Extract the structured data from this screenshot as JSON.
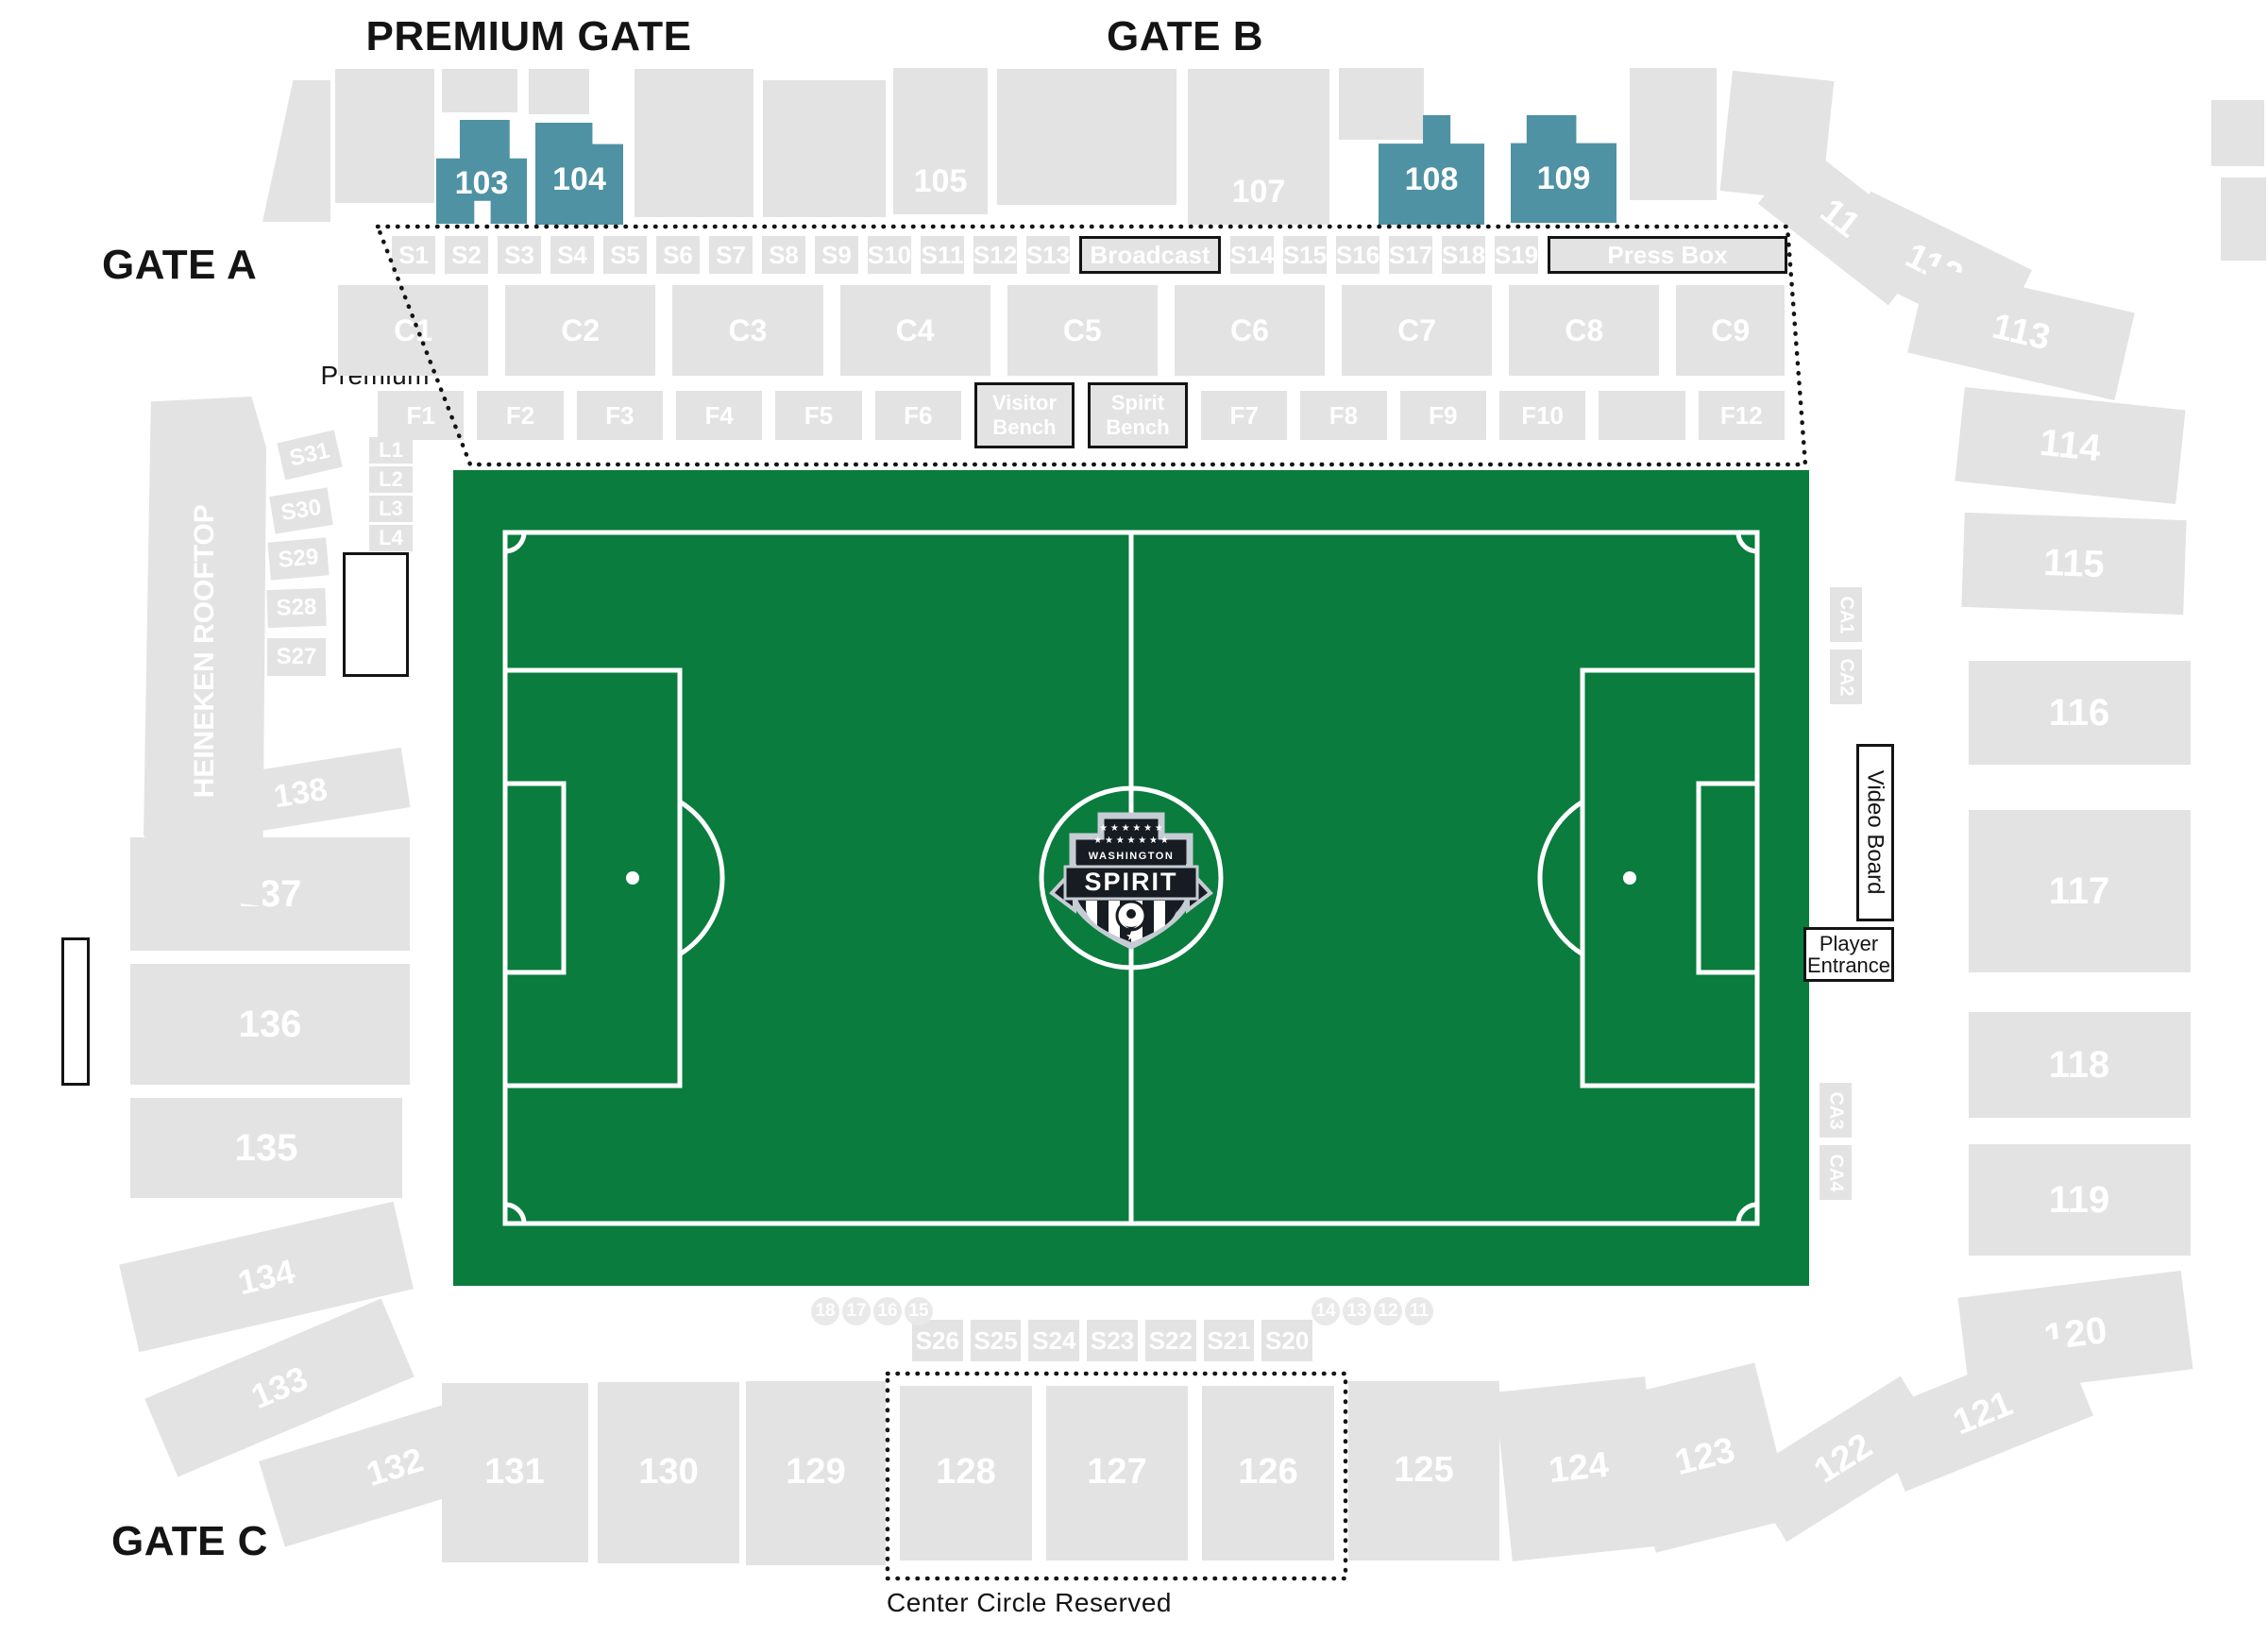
{
  "titles": {
    "premium_gate": "PREMIUM GATE",
    "gate_b": "GATE B",
    "gate_a": "GATE A",
    "gate_c": "GATE C",
    "premium": "Premium",
    "center_circle": "Center Circle Reserved"
  },
  "colors": {
    "section_gray": "#e3e3e3",
    "highlight_teal": "#4e92a3",
    "field_green": "#0a7c3e",
    "line_white": "#ffffff",
    "text_black": "#141414"
  },
  "field": {
    "team_city": "WASHINGTON",
    "team_name": "SPIRIT"
  },
  "premium_boxes": {
    "broadcast": "Broadcast",
    "press_box": "Press Box",
    "visitor_bench_line1": "Visitor",
    "visitor_bench_line2": "Bench",
    "spirit_bench_line1": "Spirit",
    "spirit_bench_line2": "Bench"
  },
  "right_labels": {
    "video_board": "Video Board",
    "player_entrance_line1": "Player",
    "player_entrance_line2": "Entrance",
    "ca": [
      "CA1",
      "CA2",
      "CA3",
      "CA4"
    ]
  },
  "left_labels": {
    "rooftop": "HEINEKEN ROOFTOP"
  },
  "sections": {
    "premium_suites": [
      "103",
      "104",
      "108",
      "109"
    ],
    "suite_level": [
      "105",
      "107"
    ],
    "s_top_a": [
      "S1",
      "S2",
      "S3",
      "S4",
      "S5",
      "S6",
      "S7",
      "S8",
      "S9",
      "S10",
      "S11",
      "S12",
      "S13"
    ],
    "s_top_b": [
      "S14",
      "S15",
      "S16",
      "S17",
      "S18",
      "S19"
    ],
    "c_row": [
      "C1",
      "C2",
      "C3",
      "C4",
      "C5",
      "C6",
      "C7",
      "C8",
      "C9"
    ],
    "f_left": [
      "F1",
      "F2",
      "F3",
      "F4",
      "F5",
      "F6"
    ],
    "f_right": [
      "F7",
      "F8",
      "F9",
      "F10",
      "",
      "F12"
    ],
    "s_bottom": [
      "S26",
      "S25",
      "S24",
      "S23",
      "S22",
      "S21",
      "S20"
    ],
    "side_left": [
      "S31",
      "S30",
      "S29",
      "S28",
      "S27"
    ],
    "lounge": [
      "L1",
      "L2",
      "L3",
      "L4"
    ],
    "east": [
      "111",
      "112",
      "113",
      "114",
      "115",
      "116",
      "117",
      "118",
      "119",
      "120",
      "121",
      "122"
    ],
    "west": [
      "138",
      "137",
      "136",
      "135",
      "134",
      "133"
    ],
    "south": [
      "132",
      "131",
      "130",
      "129",
      "128",
      "127",
      "126",
      "125",
      "124",
      "123"
    ]
  },
  "field_numbers_left": [
    "18",
    "17",
    "16",
    "15"
  ],
  "field_numbers_right": [
    "14",
    "13",
    "12",
    "11"
  ]
}
